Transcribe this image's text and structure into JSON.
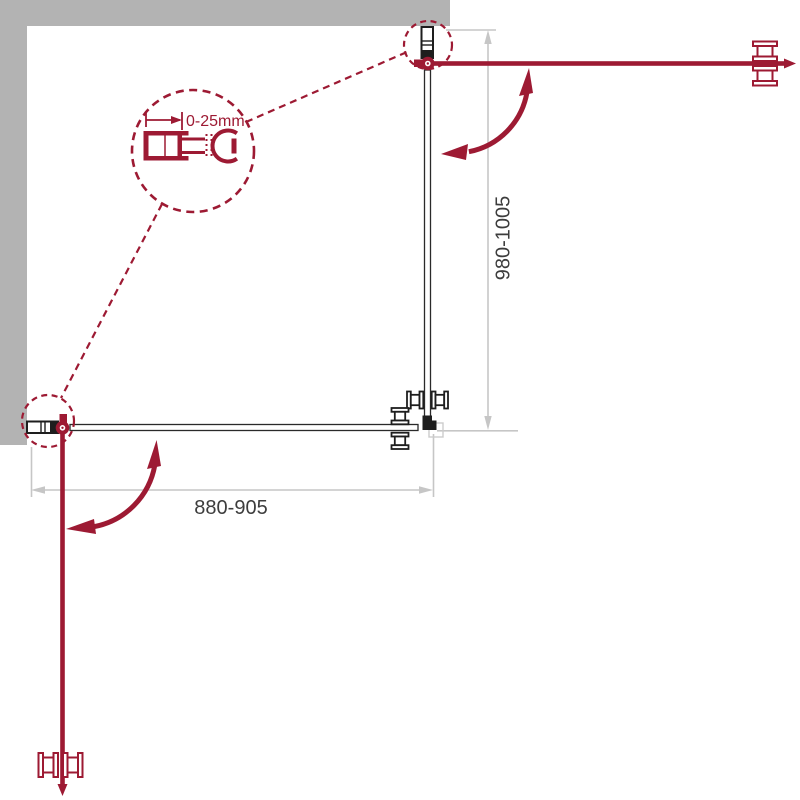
{
  "drawing": {
    "type": "shower-enclosure-plan-view",
    "labels": {
      "adjustment_detail": "0-25mm",
      "width_range": "880-905",
      "depth_range": "980-1005"
    }
  },
  "colors": {
    "accent_red": "#9d1a33",
    "wall_gray": "#b3b3b3",
    "dimension_line_gray": "#c6c6c6",
    "dimension_text": "#3d3d3d",
    "profile_dark": "#1e1e1e",
    "glass_line": "#2a2a2a",
    "background": "#ffffff"
  }
}
